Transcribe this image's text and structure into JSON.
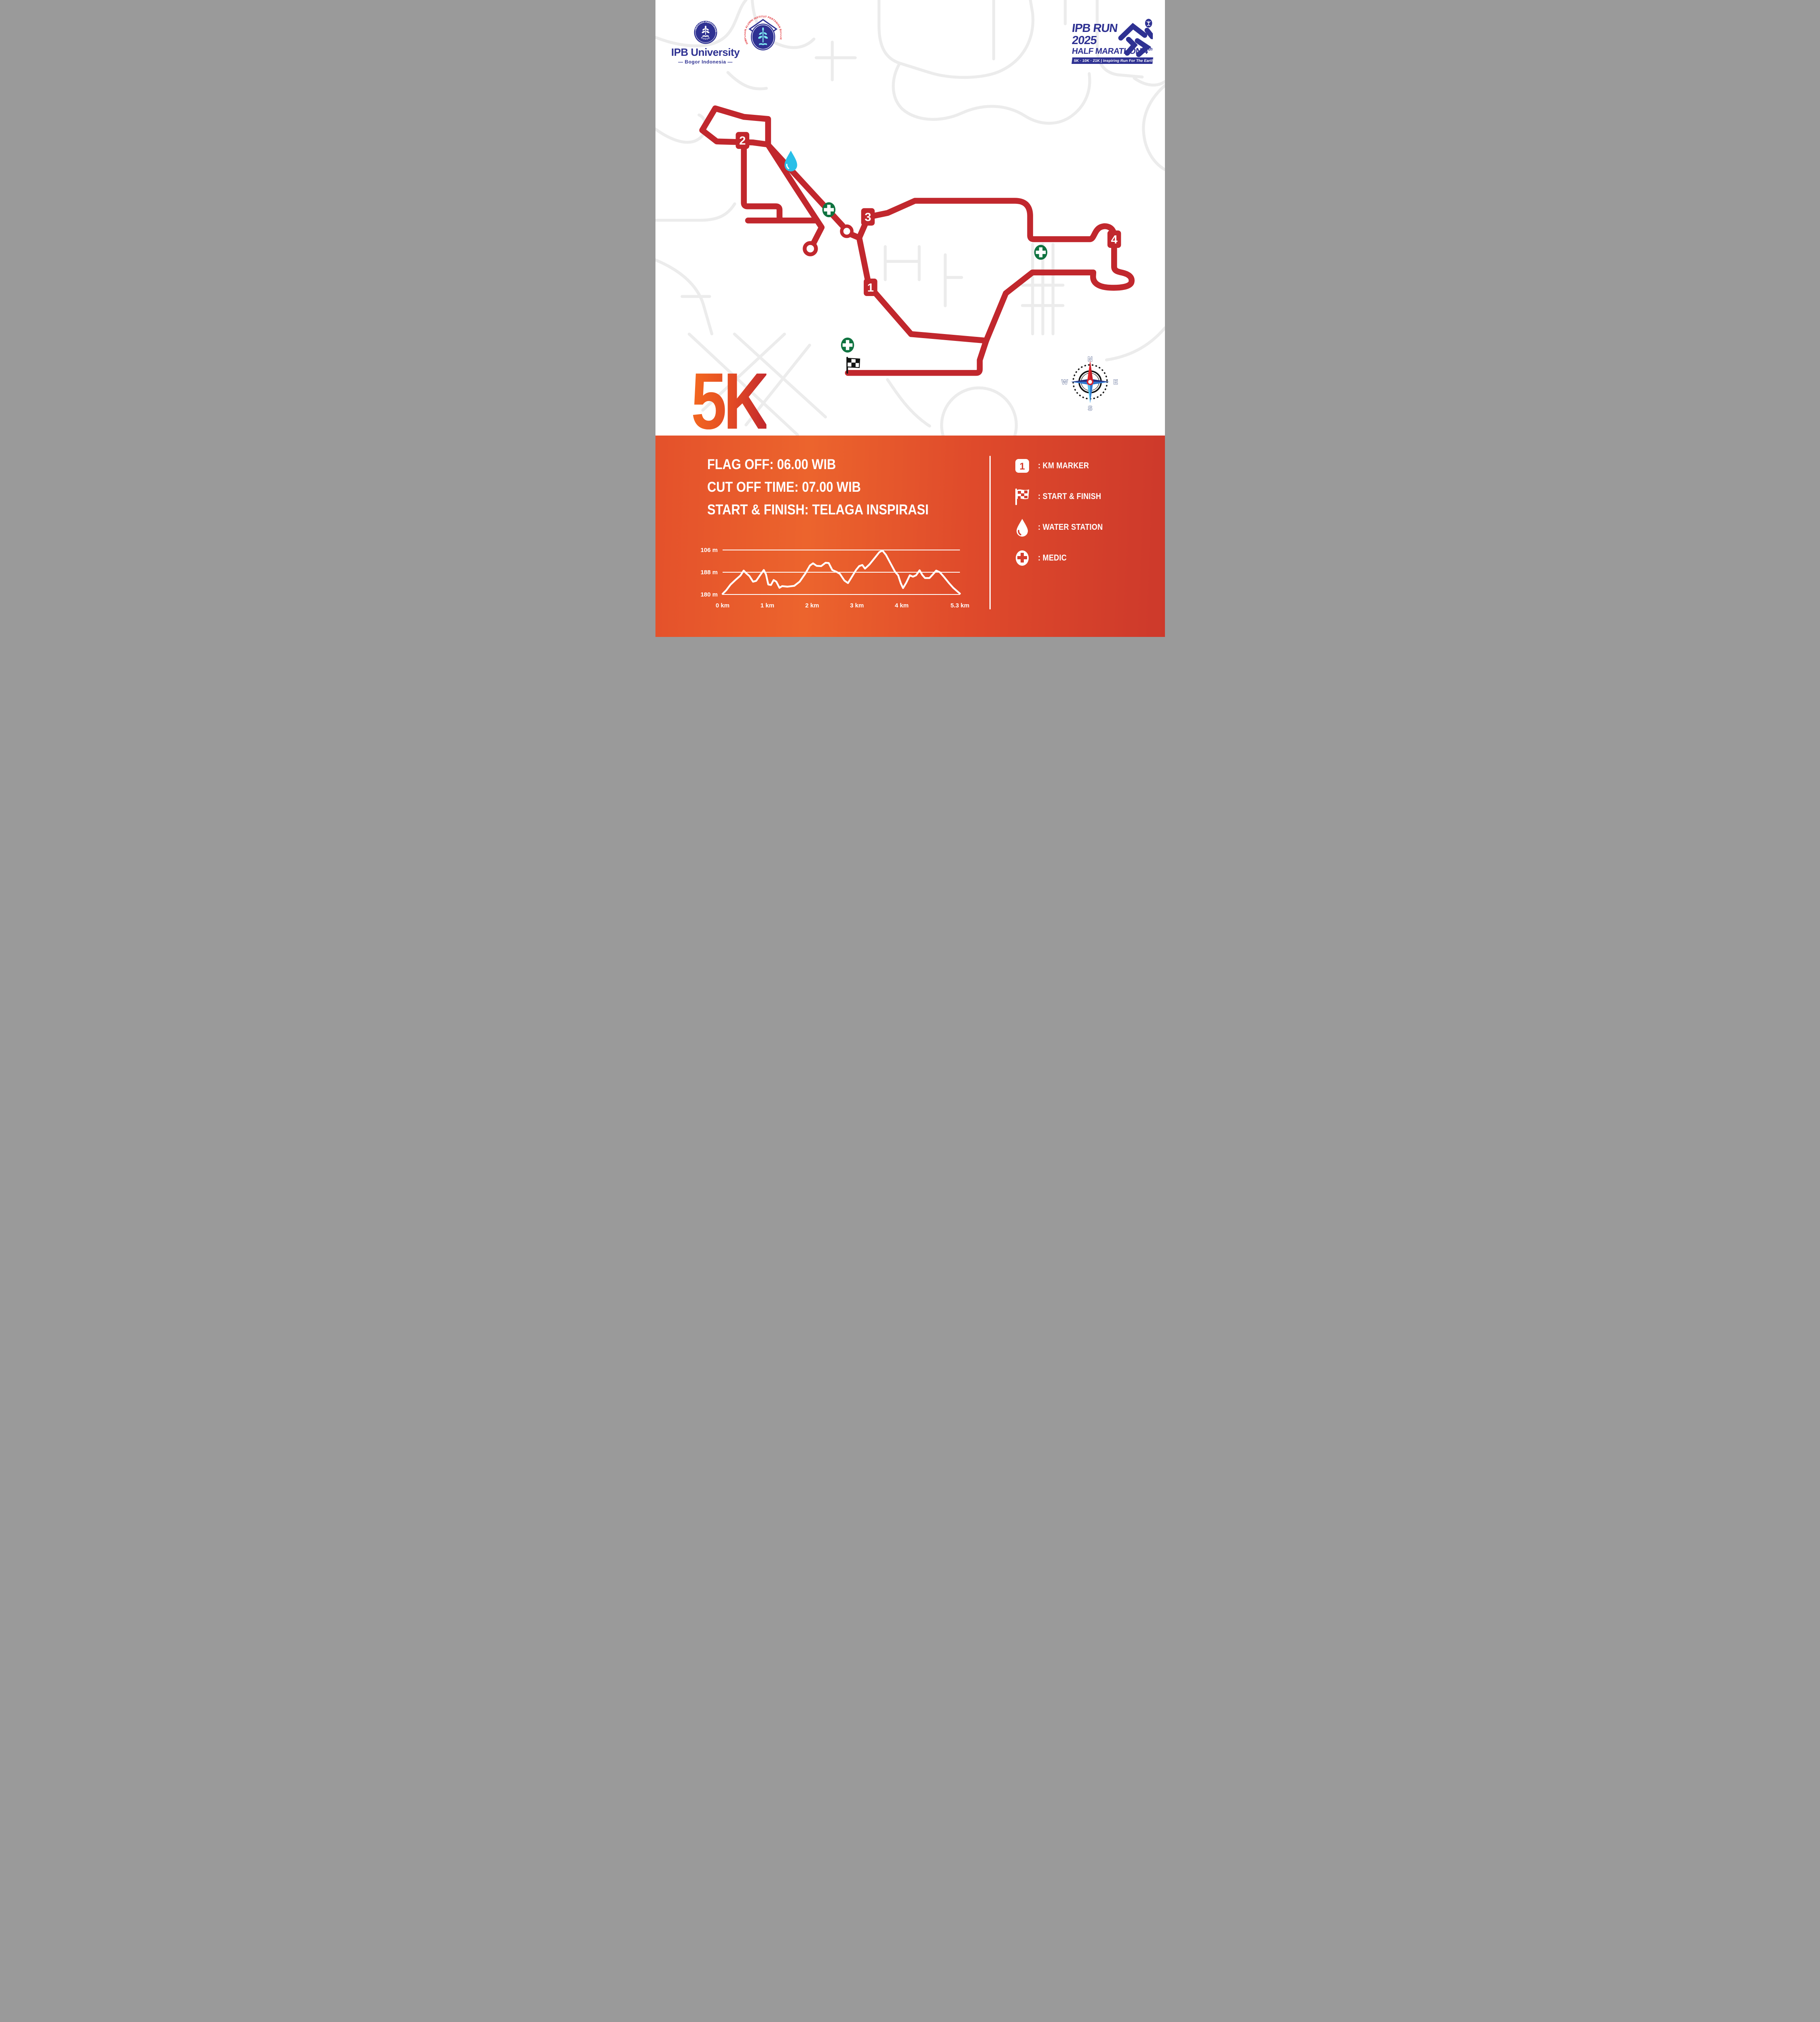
{
  "header": {
    "ipb_logo": {
      "name": "IPB University",
      "subtitle": "— Bogor Indonesia —",
      "seal_top_text": "INSTITUT PERTANIAN",
      "seal_bottom_text": "BOGOR"
    },
    "alumni_logo": {
      "arc_text": "HIMPUNAN ALUMNI INSTITUT PERTANIAN BOGOR"
    },
    "event_logo": {
      "title_line1": "IPB RUN",
      "title_line2": "2025",
      "title_line3": "HALF MARATHON",
      "edition_number": "4",
      "edition_suffix": "th",
      "banner": "5K · 10K · 21K | Inspiring Run For The Earth"
    }
  },
  "map": {
    "race_label": "5K",
    "km_markers": [
      {
        "label": "1"
      },
      {
        "label": "2"
      },
      {
        "label": "3"
      },
      {
        "label": "4"
      }
    ],
    "compass": {
      "n": "N",
      "e": "E",
      "s": "S",
      "w": "W"
    },
    "colors": {
      "route": "#C1272D",
      "background_roads": "#ECECEC",
      "water_station": "#29BFE8",
      "medic": "#0F7340",
      "band_left": "#E4512B",
      "band_right": "#CD392B",
      "navy": "#2E3192"
    }
  },
  "info": {
    "lines": [
      "FLAG OFF: 06.00 WIB",
      "CUT OFF TIME: 07.00 WIB",
      "START & FINISH: TELAGA INSPIRASI"
    ]
  },
  "legend": {
    "km_sample": "1",
    "items": [
      {
        "icon": "km-marker",
        "label": ": KM MARKER"
      },
      {
        "icon": "checkered-flag",
        "label": ": START & FINISH"
      },
      {
        "icon": "water-drop",
        "label": ": WATER STATION"
      },
      {
        "icon": "medic-cross",
        "label": ": MEDIC"
      }
    ]
  },
  "chart_data": {
    "type": "line",
    "title": "5K elevation profile",
    "xlabel": "distance (km)",
    "ylabel": "elevation (m)",
    "x_range": [
      0,
      5.3
    ],
    "y_range": [
      180,
      196
    ],
    "grid": "horizontal-only",
    "legend_position": "none",
    "y_gridlines": [
      {
        "value": 196,
        "label": "106 m"
      },
      {
        "value": 188,
        "label": "188 m"
      },
      {
        "value": 180,
        "label": "180 m"
      }
    ],
    "x_ticks": [
      {
        "pos": 0,
        "label": "0 km"
      },
      {
        "pos": 1,
        "label": "1 km"
      },
      {
        "pos": 2,
        "label": "2 km"
      },
      {
        "pos": 3,
        "label": "3 km"
      },
      {
        "pos": 4,
        "label": "4 km"
      },
      {
        "pos": 5.3,
        "label": "5.3 km"
      }
    ],
    "points": [
      [
        0,
        180.2
      ],
      [
        0.08,
        181.5
      ],
      [
        0.18,
        183.6
      ],
      [
        0.3,
        185.4
      ],
      [
        0.4,
        186.8
      ],
      [
        0.47,
        188.6
      ],
      [
        0.53,
        187.6
      ],
      [
        0.6,
        186.6
      ],
      [
        0.68,
        184.6
      ],
      [
        0.75,
        184.9
      ],
      [
        0.85,
        187.2
      ],
      [
        0.92,
        188.8
      ],
      [
        0.97,
        187.2
      ],
      [
        1.02,
        183.6
      ],
      [
        1.08,
        183.4
      ],
      [
        1.14,
        185.2
      ],
      [
        1.2,
        184.6
      ],
      [
        1.27,
        182.4
      ],
      [
        1.33,
        183.0
      ],
      [
        1.45,
        182.8
      ],
      [
        1.6,
        183.1
      ],
      [
        1.72,
        184.6
      ],
      [
        1.85,
        187.6
      ],
      [
        1.95,
        190.4
      ],
      [
        2.02,
        191.2
      ],
      [
        2.1,
        190.3
      ],
      [
        2.2,
        190.2
      ],
      [
        2.3,
        191.4
      ],
      [
        2.37,
        191.3
      ],
      [
        2.45,
        188.8
      ],
      [
        2.55,
        188.1
      ],
      [
        2.62,
        187.4
      ],
      [
        2.72,
        185.0
      ],
      [
        2.8,
        184.1
      ],
      [
        2.88,
        186.2
      ],
      [
        2.98,
        188.8
      ],
      [
        3.05,
        190.2
      ],
      [
        3.12,
        190.6
      ],
      [
        3.18,
        189.3
      ],
      [
        3.28,
        190.8
      ],
      [
        3.4,
        193.2
      ],
      [
        3.5,
        195.2
      ],
      [
        3.57,
        195.8
      ],
      [
        3.65,
        194.2
      ],
      [
        3.75,
        191.2
      ],
      [
        3.85,
        188.2
      ],
      [
        3.92,
        186.9
      ],
      [
        3.98,
        184.0
      ],
      [
        4.03,
        182.3
      ],
      [
        4.1,
        184.2
      ],
      [
        4.18,
        186.9
      ],
      [
        4.25,
        186.4
      ],
      [
        4.32,
        186.9
      ],
      [
        4.4,
        188.7
      ],
      [
        4.46,
        187.0
      ],
      [
        4.52,
        185.9
      ],
      [
        4.62,
        185.9
      ],
      [
        4.7,
        187.3
      ],
      [
        4.77,
        188.6
      ],
      [
        4.85,
        188.0
      ],
      [
        4.95,
        186.2
      ],
      [
        5.05,
        184.2
      ],
      [
        5.15,
        182.4
      ],
      [
        5.3,
        180.3
      ]
    ]
  }
}
